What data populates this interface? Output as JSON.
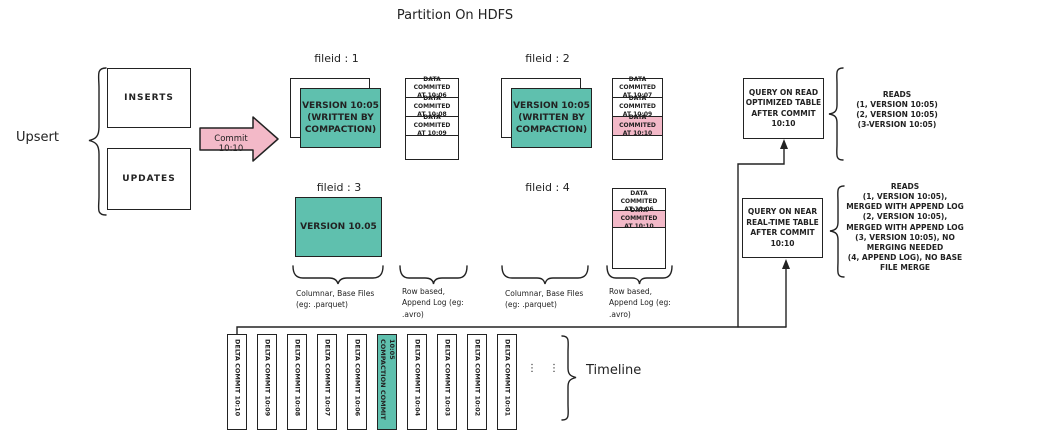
{
  "title": "Partition On HDFS",
  "colors": {
    "teal": "#5fc0ae",
    "pink": "#f3b9c8",
    "ink": "#222222"
  },
  "upsert": {
    "label": "Upsert",
    "inserts": "INSERTS",
    "updates": "UPDATES",
    "commit_arrow": "Commit 10:10"
  },
  "file_groups": {
    "f1": {
      "label": "fileid : 1",
      "base": "VERSION 10:05\n(WRITTEN BY\nCOMPACTION)",
      "log": [
        {
          "text": "DATA COMMITED\nAT 10:06"
        },
        {
          "text": "DATA COMMITED\nAT 10:08"
        },
        {
          "text": "DATA COMMITED\nAT 10:09"
        }
      ]
    },
    "f2": {
      "label": "fileid : 2",
      "base": "VERSION 10:05\n(WRITTEN BY\nCOMPACTION)",
      "log": [
        {
          "text": "DATA COMMITED\nAT 10:07"
        },
        {
          "text": "DATA COMMITED\nAT 10:09"
        },
        {
          "text": "DATA COMMITED\nAT 10:10",
          "highlight": true
        }
      ]
    },
    "f3": {
      "label": "fileid : 3",
      "base": "VERSION 10.05"
    },
    "f4": {
      "label": "fileid : 4",
      "log": [
        {
          "text": "DATA COMMITED\nAT 10:06"
        },
        {
          "text": "DATA COMMITED\nAT 10:10",
          "highlight": true
        }
      ]
    }
  },
  "storage_labels": [
    "Columnar, Base Files\n(eg: .parquet)",
    "Row based,\nAppend Log  (eg:\n.avro)",
    "Columnar, Base Files\n(eg: .parquet)",
    "Row based,\nAppend Log  (eg:\n.avro)"
  ],
  "queries": {
    "read_optimized": {
      "box_label": "QUERY ON READ\nOPTIMIZED TABLE\nAFTER COMMIT\n10:10",
      "reads": "READS\n(1, VERSION 10:05)\n(2, VERSION 10:05)\n(3-VERSION 10:05)"
    },
    "near_real_time": {
      "box_label": "QUERY ON NEAR\nREAL-TIME TABLE\nAFTER COMMIT\n10:10",
      "reads": "READS\n(1, VERSION 10:05),\nMERGED WITH APPEND LOG\n(2, VERSION 10:05),\nMERGED WITH APPEND LOG\n(3, VERSION 10:05), NO\nMERGING NEEDED\n(4, APPEND LOG), NO BASE\nFILE MERGE"
    }
  },
  "timeline": {
    "label": "Timeline",
    "ellipsis": "⋮",
    "items": [
      {
        "label": "DELTA COMMIT 10:10"
      },
      {
        "label": "DELTA COMMIT 10:09"
      },
      {
        "label": "DELTA COMMIT 10:08"
      },
      {
        "label": "DELTA COMMIT 10:07"
      },
      {
        "label": "DELTA COMMIT 10:06"
      },
      {
        "label": "COMPACTION COMMIT\n10:05",
        "highlight": true
      },
      {
        "label": "DELTA COMMIT 10:04"
      },
      {
        "label": "DELTA COMMIT 10:03"
      },
      {
        "label": "DELTA COMMIT 10:02"
      },
      {
        "label": "DELTA COMMIT 10:01"
      }
    ]
  }
}
